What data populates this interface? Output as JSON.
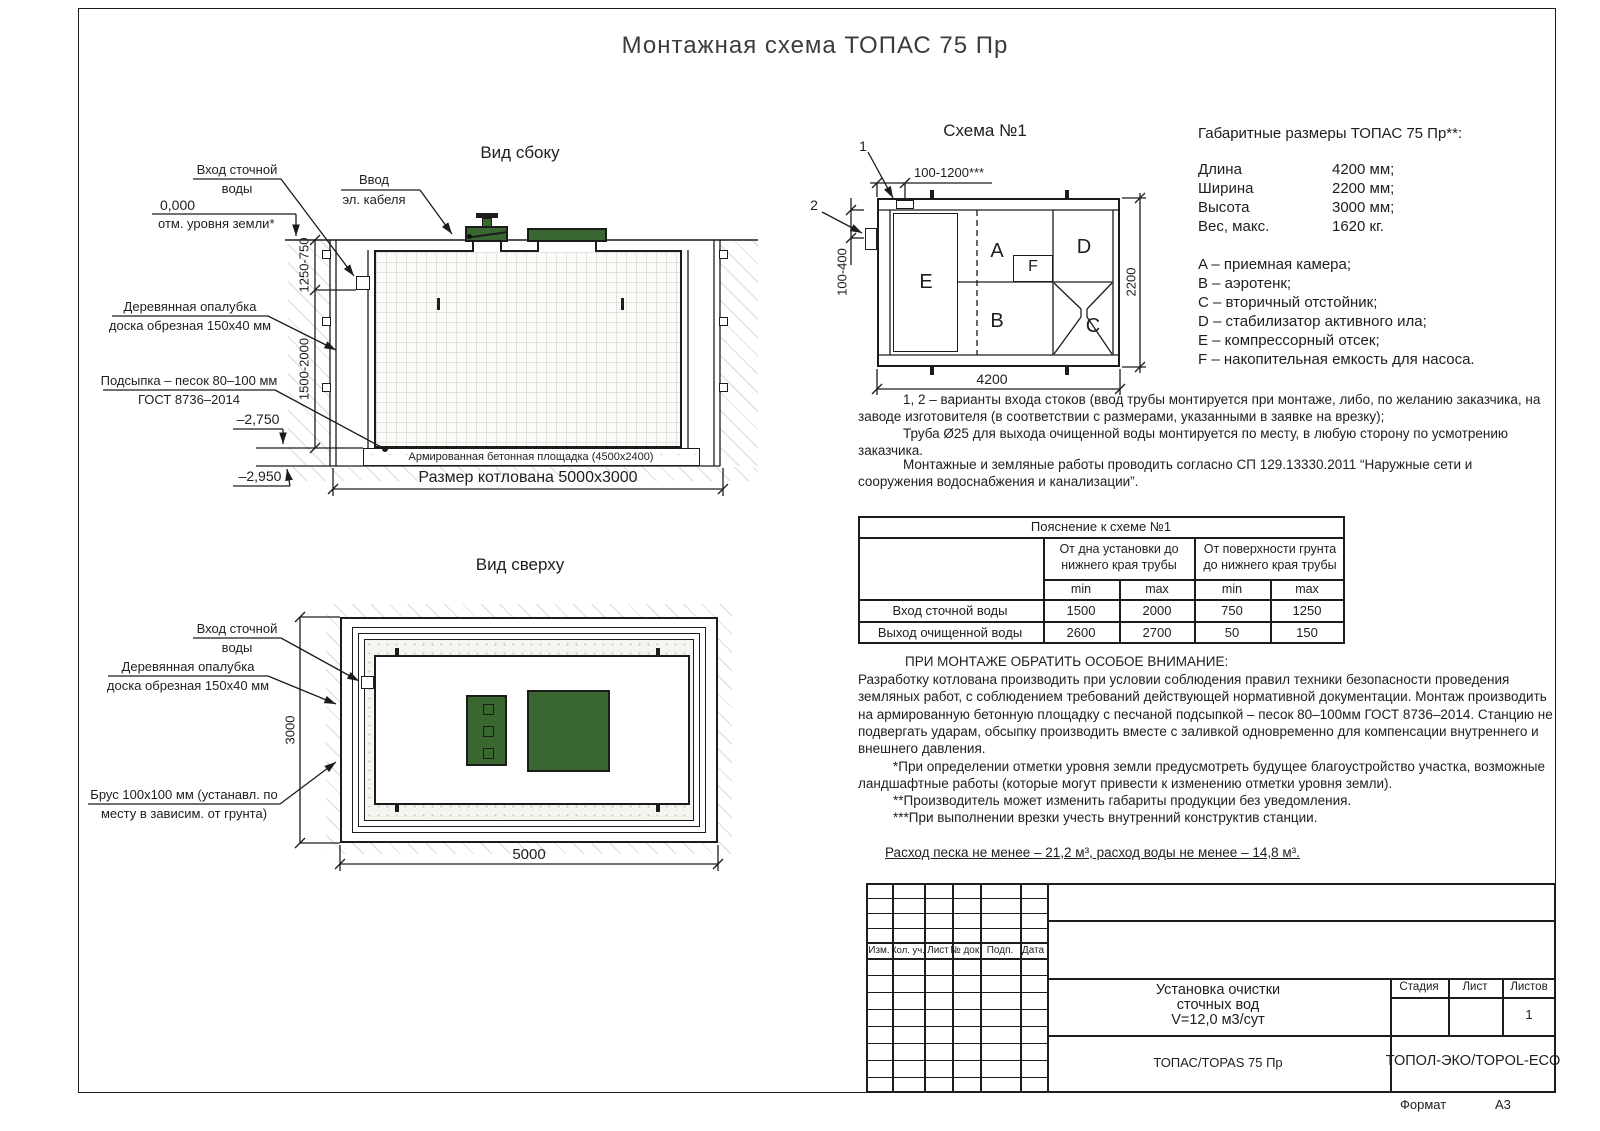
{
  "page": {
    "title": "Монтажная схема ТОПАС 75 Пр",
    "format_label": "Формат",
    "format_value": "А3"
  },
  "colors": {
    "line": "#1c1c1c",
    "lid_green": "#3a662f"
  },
  "side_view": {
    "title": "Вид сбоку",
    "labels": {
      "inlet": [
        "Вход сточной",
        "воды"
      ],
      "zero_mark": [
        "0,000",
        "отм. уровня земли*"
      ],
      "cable": [
        "Ввод",
        "эл. кабеля"
      ],
      "formwork": [
        "Деревянная опалубка",
        "доска обрезная 150х40 мм"
      ],
      "sand": [
        "Подсыпка – песок 80–100 мм",
        "ГОСТ 8736–2014"
      ],
      "elev_pad": "–2,750",
      "elev_bottom": "–2,950",
      "pad": "Армированная бетонная площадка (4500х2400)",
      "pit": "Размер котлована 5000х3000"
    },
    "dims": {
      "upper": "1250-750",
      "lower": "1500-2000"
    }
  },
  "top_view": {
    "title": "Вид сверху",
    "labels": {
      "inlet": [
        "Вход сточной",
        "воды"
      ],
      "formwork": [
        "Деревянная опалубка",
        "доска обрезная 150х40 мм"
      ],
      "beam": [
        "Брус 100х100 мм (устанавл. по",
        "месту в зависим. от грунта)"
      ]
    },
    "dims": {
      "width": "3000",
      "length": "5000"
    }
  },
  "schema": {
    "title": "Схема №1",
    "markers": {
      "m1": "1",
      "m2": "2"
    },
    "compartments": {
      "a": "A",
      "b": "B",
      "c": "C",
      "d": "D",
      "e": "E",
      "f": "F"
    },
    "dims": {
      "top": "100-1200***",
      "left": "100-400",
      "right": "2200",
      "bottom": "4200"
    }
  },
  "specs": {
    "heading": "Габаритные размеры ТОПАС 75 Пр**:",
    "rows": [
      {
        "label": "Длина",
        "value": "4200 мм;"
      },
      {
        "label": "Ширина",
        "value": "2200 мм;"
      },
      {
        "label": "Высота",
        "value": "3000 мм;"
      },
      {
        "label": "Вес, макс.",
        "value": "1620 кг."
      }
    ],
    "legend": [
      "A – приемная камера;",
      "B – аэротенк;",
      "C – вторичный отстойник;",
      "D – стабилизатор активного ила;",
      "E – компрессорный отсек;",
      "F – накопительная емкость для насоса."
    ]
  },
  "notes": {
    "variants": "1, 2 – варианты входа  стоков (ввод трубы монтируется при монтаже, либо, по желанию заказчика, на заводе изготовителя (в соответствии с размерами, указанными в заявке на врезку);",
    "pipe": "Труба Ø25 для выхода очищенной воды монтируется по месту, в любую сторону по усмотрению заказчика.",
    "works": "Монтажные и земляные работы проводить согласно СП 129.13330.2011 “Наружные сети и сооружения водоснабжения и канализации”."
  },
  "table": {
    "title": "Пояснение к схеме №1",
    "group1": "От дна установки до нижнего края трубы",
    "group2": "От поверхности грунта до нижнего края трубы",
    "min_label": "min",
    "max_label": "max",
    "rows": [
      {
        "label": "Вход сточной воды",
        "values": [
          "1500",
          "2000",
          "750",
          "1250"
        ]
      },
      {
        "label": "Выход очищенной воды",
        "values": [
          "2600",
          "2700",
          "50",
          "150"
        ]
      }
    ]
  },
  "attention": {
    "heading": "ПРИ МОНТАЖЕ ОБРАТИТЬ ОСОБОЕ ВНИМАНИЕ:",
    "body": "Разработку котлована производить при условии соблюдения правил техники безопасности проведения земляных работ, с соблюдением требований действующей нормативной документации.  Монтаж производить на армированную бетонную площадку с песчаной подсыпкой – песок 80–100мм ГОСТ 8736–2014. Станцию не подвергать ударам, обсыпку производить вместе с заливкой одновременно для компенсации внутреннего и внешнего давления.",
    "fn1": "*При определении отметки уровня земли предусмотреть будущее благоустройство участка, возможные ландшафтные работы (которые могут привести к изменению отметки уровня земли).",
    "fn2": "**Производитель может изменить габариты продукции без уведомления.",
    "fn3": "***При выполнении врезки учесть внутренний конструктив станции.",
    "consumption": "Расход песка не менее – 21,2 м³, расход воды не менее – 14,8 м³."
  },
  "stamp": {
    "columns": [
      "Изм.",
      "Кол. уч.",
      "Лист",
      "№ док.",
      "Подп.",
      "Дата"
    ],
    "doc_title": [
      "Установка очистки",
      "сточных вод",
      "V=12,0 м3/сут"
    ],
    "stage_label": "Стадия",
    "sheet_label": "Лист",
    "sheets_label": "Листов",
    "sheets_value": "1",
    "model": "ТОПАС/TOPAS 75 Пр",
    "company": "ТОПОЛ-ЭКО/TOPOL-ECO"
  }
}
